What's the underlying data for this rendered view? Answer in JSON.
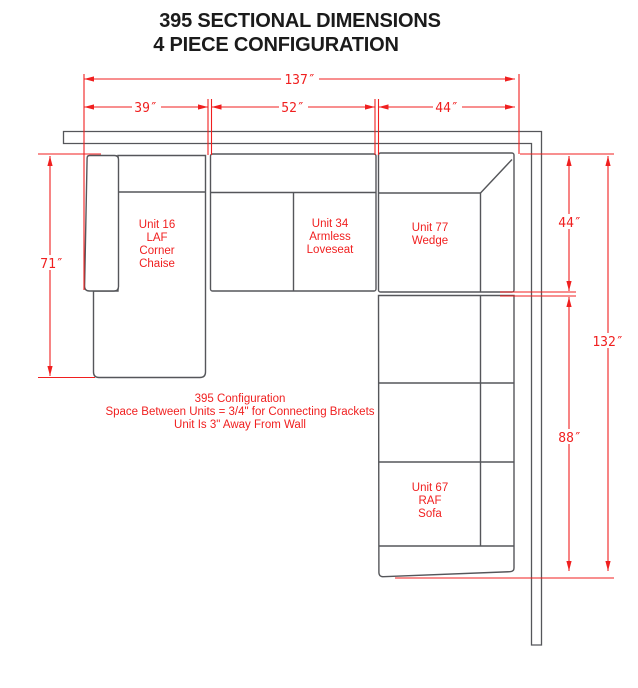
{
  "title": {
    "line1": "395 SECTIONAL DIMENSIONS",
    "line2": "4 PIECE CONFIGURATION"
  },
  "dims": {
    "total_width": "137″",
    "chaise_width": "39″",
    "loveseat_width": "52″",
    "wedge_width": "44″",
    "chaise_depth": "71″",
    "wedge_depth": "44″",
    "total_depth": "132″",
    "sofa_length": "88″"
  },
  "units": {
    "chaise": {
      "lines": [
        "Unit 16",
        "LAF",
        "Corner",
        "Chaise"
      ]
    },
    "loveseat": {
      "lines": [
        "Unit 34",
        "Armless",
        "Loveseat"
      ]
    },
    "wedge": {
      "lines": [
        "Unit 77",
        "Wedge"
      ]
    },
    "sofa": {
      "lines": [
        "Unit 67",
        "RAF",
        "Sofa"
      ]
    }
  },
  "note": {
    "line1": "395 Configuration",
    "line2": "Space Between Units = 3/4\" for Connecting Brackets",
    "line3": "Unit Is 3\" Away From Wall"
  },
  "colors": {
    "dimension_red": "#f01f1f",
    "outline_gray": "#55565a",
    "title_black": "#1b1b1b"
  }
}
